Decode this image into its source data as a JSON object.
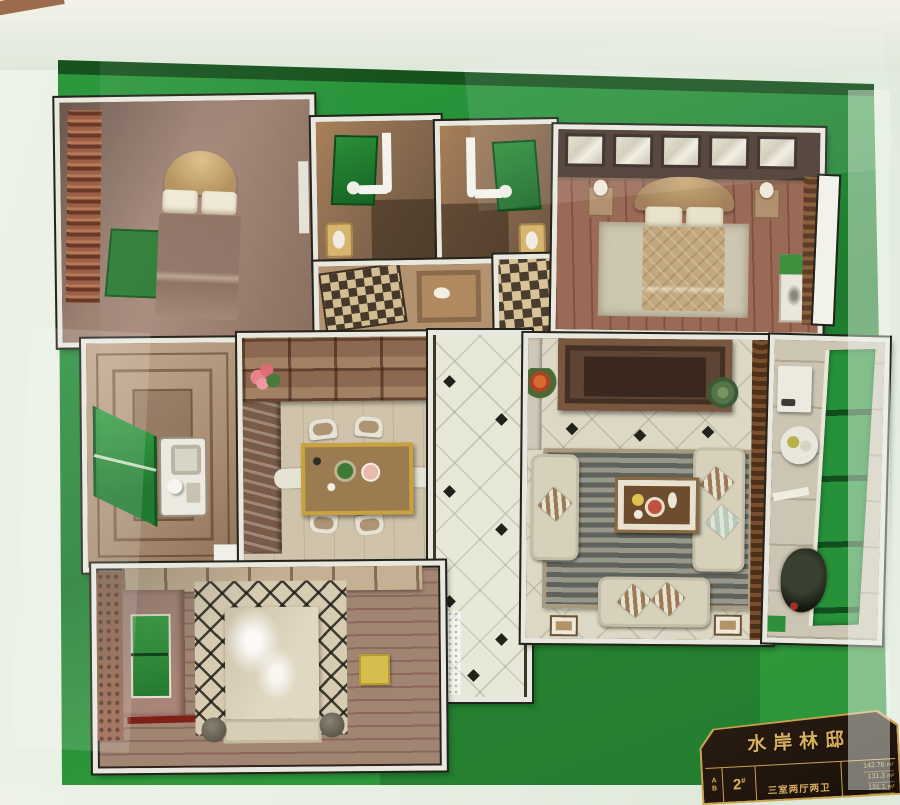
{
  "plaque": {
    "title": "水岸林邸",
    "row_labels": [
      "A",
      "B"
    ],
    "unit_number": "2",
    "unit_suffix": "#",
    "layout": "三室两厅两卫",
    "areas": [
      {
        "value": "142.76",
        "unit": "m²"
      },
      {
        "value": "131.3",
        "unit": "m²"
      },
      {
        "value": "131.1",
        "unit": "m²"
      }
    ]
  },
  "colors": {
    "felt_green": "#2f9a3c",
    "felt_shadow": "#1d7a2e",
    "felt_dark_band": "#17531f",
    "case_glass": "#e9efe4",
    "wall_white": "#e8e8df",
    "wall_outline": "#23231c",
    "shower_green": "#1f7c2d",
    "balcony_glass_green": "#27913a",
    "wood_floor_master": "#9a6a57",
    "hall_tile": "#e7e8d7",
    "plaque_bg": "#21150d",
    "plaque_gold": "#d8b15f"
  }
}
